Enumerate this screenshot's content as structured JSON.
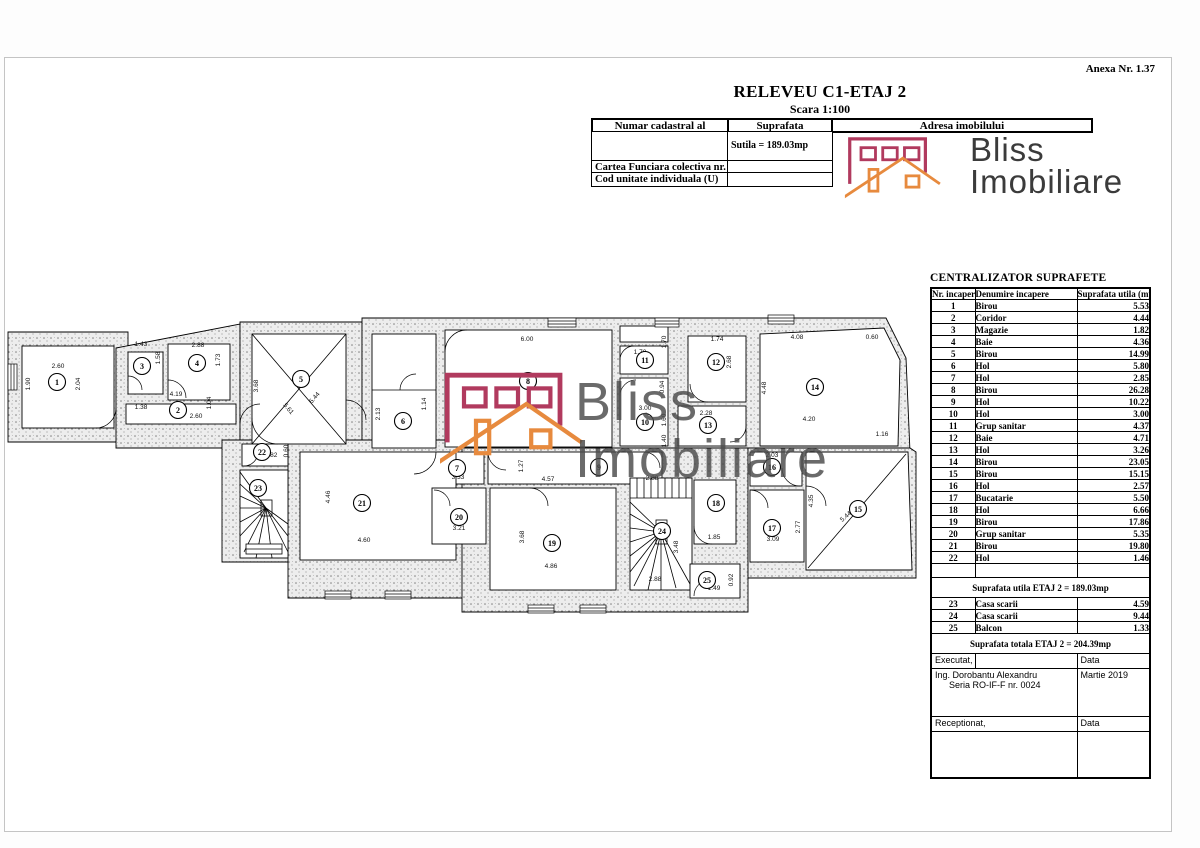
{
  "page": {
    "anexa": "Anexa Nr. 1.37",
    "title": "RELEVEU C1-ETAJ 2",
    "scale": "Scara 1:100"
  },
  "header_table": {
    "col1": "Numar cadastral al terenului",
    "col2": "Suprafata",
    "col3": "Adresa imobilului",
    "sutila": "Sutila =  189.03mp",
    "row3": "Cartea Funciara colectiva nr.",
    "row4": "Cod unitate individuala (U)"
  },
  "logo": {
    "line1": "Bliss",
    "line2": "Imobiliare",
    "maroon": "#b13a5e",
    "orange": "#e78a3e"
  },
  "watermark": {
    "line1": "Bliss",
    "line2": "Imobiliare"
  },
  "surface_table": {
    "title": "CENTRALIZATOR SUPRAFETE",
    "h_nr": "Nr.\nincapere",
    "h_den": "Denumire\nincapere",
    "h_sup": "Suprafata utila\n(mp)",
    "rows": [
      [
        "1",
        "Birou",
        "5.53"
      ],
      [
        "2",
        "Coridor",
        "4.44"
      ],
      [
        "3",
        "Magazie",
        "1.82"
      ],
      [
        "4",
        "Baie",
        "4.36"
      ],
      [
        "5",
        "Birou",
        "14.99"
      ],
      [
        "6",
        "Hol",
        "5.80"
      ],
      [
        "7",
        "Hol",
        "2.85"
      ],
      [
        "8",
        "Birou",
        "26.28"
      ],
      [
        "9",
        "Hol",
        "10.22"
      ],
      [
        "10",
        "Hol",
        "3.00"
      ],
      [
        "11",
        "Grup sanitar",
        "4.37"
      ],
      [
        "12",
        "Baie",
        "4.71"
      ],
      [
        "13",
        "Hol",
        "3.26"
      ],
      [
        "14",
        "Birou",
        "23.05"
      ],
      [
        "15",
        "Birou",
        "15.15"
      ],
      [
        "16",
        "Hol",
        "2.57"
      ],
      [
        "17",
        "Bucatarie",
        "5.50"
      ],
      [
        "18",
        "Hol",
        "6.66"
      ],
      [
        "19",
        "Birou",
        "17.86"
      ],
      [
        "20",
        "Grup sanitar",
        "5.35"
      ],
      [
        "21",
        "Birou",
        "19.80"
      ],
      [
        "22",
        "Hol",
        "1.46"
      ]
    ],
    "subtotal": "Suprafata utila ETAJ 2 = 189.03mp",
    "extra_rows": [
      [
        "23",
        "Casa scarii",
        "4.59"
      ],
      [
        "24",
        "Casa scarii",
        "9.44"
      ],
      [
        "25",
        "Balcon",
        "1.33"
      ]
    ],
    "total": "Suprafata totala ETAJ 2 = 204.39mp",
    "sig": {
      "executat": "Executat,",
      "data1": "Data",
      "name": "Ing. Dorobantu Alexandru",
      "serie": "Seria RO-IF-F nr. 0024",
      "date": "Martie 2019",
      "receptionat": "Receptionat,",
      "data2": "Data"
    }
  },
  "floor_plan": {
    "rooms": [
      [
        "1",
        57,
        382
      ],
      [
        "2",
        178,
        410
      ],
      [
        "3",
        142,
        366
      ],
      [
        "4",
        197,
        363
      ],
      [
        "5",
        301,
        379
      ],
      [
        "6",
        403,
        421
      ],
      [
        "7",
        457,
        468
      ],
      [
        "8",
        528,
        381
      ],
      [
        "9",
        599,
        467
      ],
      [
        "10",
        645,
        422
      ],
      [
        "11",
        645,
        360
      ],
      [
        "12",
        716,
        362
      ],
      [
        "13",
        708,
        425
      ],
      [
        "14",
        815,
        387
      ],
      [
        "15",
        858,
        509
      ],
      [
        "16",
        772,
        467
      ],
      [
        "17",
        772,
        528
      ],
      [
        "18",
        716,
        503
      ],
      [
        "19",
        552,
        543
      ],
      [
        "20",
        459,
        517
      ],
      [
        "21",
        362,
        503
      ],
      [
        "22",
        262,
        452
      ],
      [
        "23",
        258,
        488
      ],
      [
        "24",
        662,
        531
      ],
      [
        "25",
        707,
        580
      ]
    ],
    "dims": [
      [
        "2.60",
        58,
        368,
        0
      ],
      [
        "1.90",
        30,
        384,
        -90
      ],
      [
        "2.04",
        80,
        384,
        -90
      ],
      [
        "1.43",
        141,
        346,
        0
      ],
      [
        "1.58",
        160,
        358,
        -90
      ],
      [
        "2.88",
        198,
        347,
        0
      ],
      [
        "1.73",
        220,
        360,
        -90
      ],
      [
        "4.19",
        176,
        396,
        0
      ],
      [
        "1.04",
        211,
        403,
        -90
      ],
      [
        "1.38",
        141,
        409,
        0
      ],
      [
        "2.60",
        196,
        418,
        0
      ],
      [
        "3.68",
        258,
        386,
        -90
      ],
      [
        "5.61",
        287,
        410,
        49
      ],
      [
        "5.44",
        316,
        399,
        -49
      ],
      [
        "2.13",
        380,
        414,
        -90
      ],
      [
        "6.00",
        527,
        341,
        0
      ],
      [
        "1.14",
        426,
        404,
        -90
      ],
      [
        "1.70",
        640,
        354,
        0
      ],
      [
        "1.70",
        666,
        342,
        -90
      ],
      [
        "0.94",
        664,
        387,
        -90
      ],
      [
        "3.00",
        645,
        410,
        0
      ],
      [
        "1.60",
        666,
        420,
        -90
      ],
      [
        "1.40",
        666,
        441,
        -90
      ],
      [
        "1.74",
        717,
        341,
        0
      ],
      [
        "2.68",
        731,
        362,
        -90
      ],
      [
        "2.28",
        706,
        415,
        0
      ],
      [
        "4.08",
        797,
        339,
        0
      ],
      [
        "0.60",
        872,
        339,
        0
      ],
      [
        "4.48",
        766,
        388,
        -90
      ],
      [
        "4.20",
        809,
        421,
        0
      ],
      [
        "1.16",
        882,
        436,
        0
      ],
      [
        "4.57",
        548,
        481,
        0
      ],
      [
        "2.88",
        652,
        480,
        0
      ],
      [
        "1.27",
        523,
        466,
        -90
      ],
      [
        "3.33",
        458,
        479,
        0
      ],
      [
        "2.03",
        772,
        457,
        0
      ],
      [
        "1.82",
        271,
        457,
        0
      ],
      [
        "0.60",
        288,
        451,
        -90
      ],
      [
        "4.46",
        330,
        497,
        -90
      ],
      [
        "4.60",
        364,
        542,
        0
      ],
      [
        "3.21",
        459,
        530,
        0
      ],
      [
        "3.68",
        524,
        537,
        -90
      ],
      [
        "4.86",
        551,
        568,
        0
      ],
      [
        "3.48",
        678,
        547,
        -90
      ],
      [
        "2.88",
        655,
        581,
        0
      ],
      [
        "1.85",
        714,
        539,
        0
      ],
      [
        "3.09",
        773,
        541,
        0
      ],
      [
        "2.77",
        800,
        527,
        -90
      ],
      [
        "4.35",
        813,
        501,
        -90
      ],
      [
        "5.44",
        847,
        518,
        -41
      ],
      [
        "1.49",
        714,
        590,
        0
      ],
      [
        "0.92",
        733,
        580,
        -90
      ]
    ]
  }
}
